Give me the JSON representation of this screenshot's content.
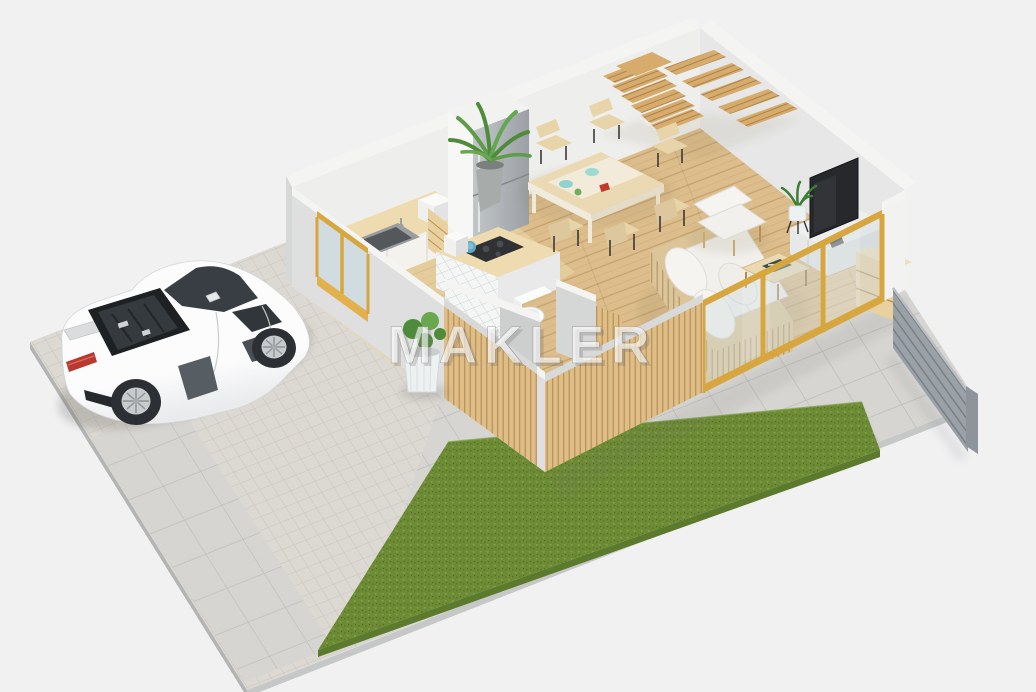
{
  "watermark": {
    "text": "MAKLER"
  },
  "scene": {
    "description": "3D isometric floor-plan render of a house ground floor with parked sports car, paver driveway, tiled patio and lawn",
    "rooms": [
      "kitchen",
      "dining-area",
      "living-room",
      "wc",
      "staircase-corner"
    ],
    "objects": [
      "white-sports-car",
      "paver-driveway",
      "patio-tiles",
      "lawn-strip",
      "kitchen-counter-with-sink",
      "fridge",
      "kitchen-island-with-cooktop",
      "dining-table",
      "dining-chairs",
      "wooden-staircase",
      "slatted-sofa",
      "armchair",
      "coffee-table",
      "tv-on-sideboard",
      "wood-cabinet",
      "potted-plants",
      "toilet",
      "glass-sliding-doors",
      "gold-framed-window",
      "wood-slat-facade",
      "gray-privacy-fence"
    ],
    "dining_chairs_count": 6,
    "glass_door_posts_count": 4
  },
  "colors": {
    "bg": "#f1f1f2",
    "rim": "#b3b5b4",
    "rim2": "#c6c8c7",
    "paver": "#dcd8d2",
    "paver_line": "#cac4bc",
    "tile": "#d6d5d1",
    "tile_line": "#bcbbb7",
    "grass": "#6d8b35",
    "grass_dark": "#5c7a2c",
    "grass_light": "#82a04a",
    "wood_floor": "#dcbd8b",
    "kitchen_floor": "#ecd8ab",
    "wall_inner_l": "#eeeeec",
    "wall_inner_r": "#e6e7e6",
    "wall_top": "#f4f4f3",
    "wall_front": "#dedfde",
    "wall_end": "#d6d8d7",
    "slat_wood": "#dfbd85",
    "slat_cap": "#d8dad9",
    "gold": "#d8a63f",
    "gold_bright": "#e2b14e",
    "glass": "#cfdce0",
    "fence": "#9aa1a7",
    "fence_post": "#8d949b",
    "stair_wood": "#d6ab6b",
    "counter_wood": "#eedcb0",
    "cabinet_white": "#f4f2ec",
    "steel_a": "#c2c6c9",
    "steel_b": "#9ba0a4",
    "sofa_wood": "#dcc598",
    "cushion": "#f1f0ec",
    "pillow": "#f5f4f0",
    "bench_cushion": "#f3ead8",
    "table_wood": "#ead9b2",
    "chair_wood": "#e7d4a9",
    "chair_leg": "#3a3a3a",
    "tv_screen": "#26282c",
    "sideboard": "#eef0ef",
    "sideboard_side": "#dcdedd",
    "cab_wood": "#e9d09f",
    "plant_dark": "#4e8c3c",
    "plant_light": "#6aa84f",
    "pot_gray": "#a7acab",
    "pot_white": "#eef1f1",
    "wc_gray": "#cdcfcf",
    "wc_tile": "#f4f5f5",
    "toilet_white": "#fbfcfc",
    "car_body": "#fcfcfd",
    "car_body2": "#e9ebec",
    "car_glass": "#383e43",
    "car_dark": "#1e2124",
    "car_blade": "#565d63",
    "car_red": "#b63a31",
    "wheel_dark": "#2c2f33",
    "rim_metal": "#c8cbcd"
  }
}
